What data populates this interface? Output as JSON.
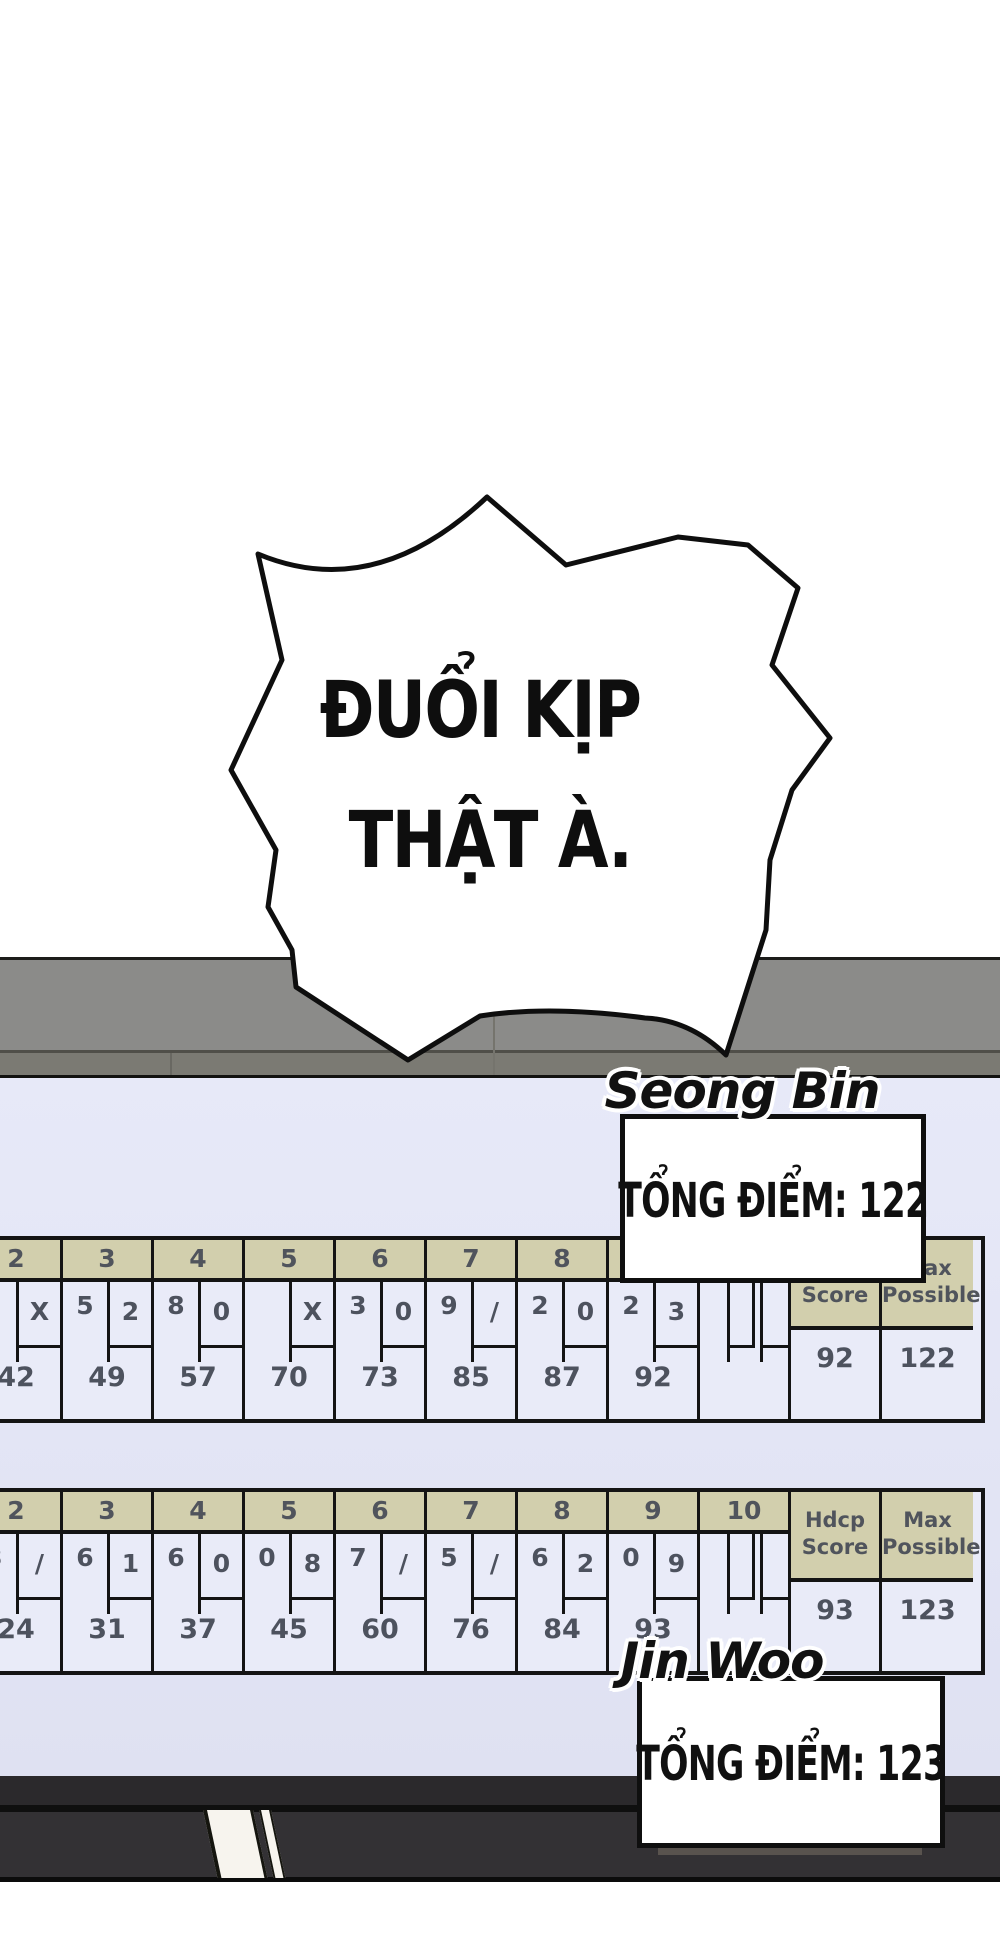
{
  "bubble": {
    "line1": "ĐUỔI KỊP",
    "line2": "THẬT À."
  },
  "players": [
    {
      "name": "Seong Bin",
      "total": "TỔNG ĐIỂM: 122"
    },
    {
      "name": "Jin Woo",
      "total": "TỔNG ĐIỂM: 123"
    }
  ],
  "scoreboards": [
    {
      "frames": [
        {
          "num": "2",
          "t1": "",
          "t2": "X",
          "score": "42"
        },
        {
          "num": "3",
          "t1": "5",
          "t2": "2",
          "score": "49"
        },
        {
          "num": "4",
          "t1": "8",
          "t2": "0",
          "score": "57"
        },
        {
          "num": "5",
          "t1": "",
          "t2": "X",
          "score": "70"
        },
        {
          "num": "6",
          "t1": "3",
          "t2": "0",
          "score": "73"
        },
        {
          "num": "7",
          "t1": "9",
          "t2": "/",
          "score": "85"
        },
        {
          "num": "8",
          "t1": "2",
          "t2": "0",
          "score": "87"
        },
        {
          "num": "9",
          "t1": "2",
          "t2": "3",
          "score": "92"
        },
        {
          "num": "10",
          "t1": "",
          "t2": "",
          "score": "",
          "tenth": true
        }
      ],
      "columns": [
        {
          "lines": [
            "Hdcp",
            "Score"
          ],
          "value": "92"
        },
        {
          "lines": [
            "Max",
            "Possible"
          ],
          "value": "122"
        }
      ]
    },
    {
      "frames": [
        {
          "num": "2",
          "t1": "3",
          "t2": "/",
          "score": "24"
        },
        {
          "num": "3",
          "t1": "6",
          "t2": "1",
          "score": "31"
        },
        {
          "num": "4",
          "t1": "6",
          "t2": "0",
          "score": "37"
        },
        {
          "num": "5",
          "t1": "0",
          "t2": "8",
          "score": "45"
        },
        {
          "num": "6",
          "t1": "7",
          "t2": "/",
          "score": "60"
        },
        {
          "num": "7",
          "t1": "5",
          "t2": "/",
          "score": "76"
        },
        {
          "num": "8",
          "t1": "6",
          "t2": "2",
          "score": "84"
        },
        {
          "num": "9",
          "t1": "0",
          "t2": "9",
          "score": "93"
        },
        {
          "num": "10",
          "t1": "",
          "t2": "",
          "score": "",
          "tenth": true
        }
      ],
      "columns": [
        {
          "lines": [
            "Hdcp",
            "Score"
          ],
          "value": "93"
        },
        {
          "lines": [
            "Max",
            "Possible"
          ],
          "value": "123"
        }
      ]
    }
  ],
  "colors": {
    "screen": "#e0e2f3",
    "cell": "#e9ebf8",
    "header_tan": "#d2cfad",
    "ink": "#141414",
    "score_text": "#4d525e",
    "monitor_gray": "#8b8b89",
    "cabinet_dark": "#2b292c",
    "highlight_white": "#f7f4ee"
  }
}
